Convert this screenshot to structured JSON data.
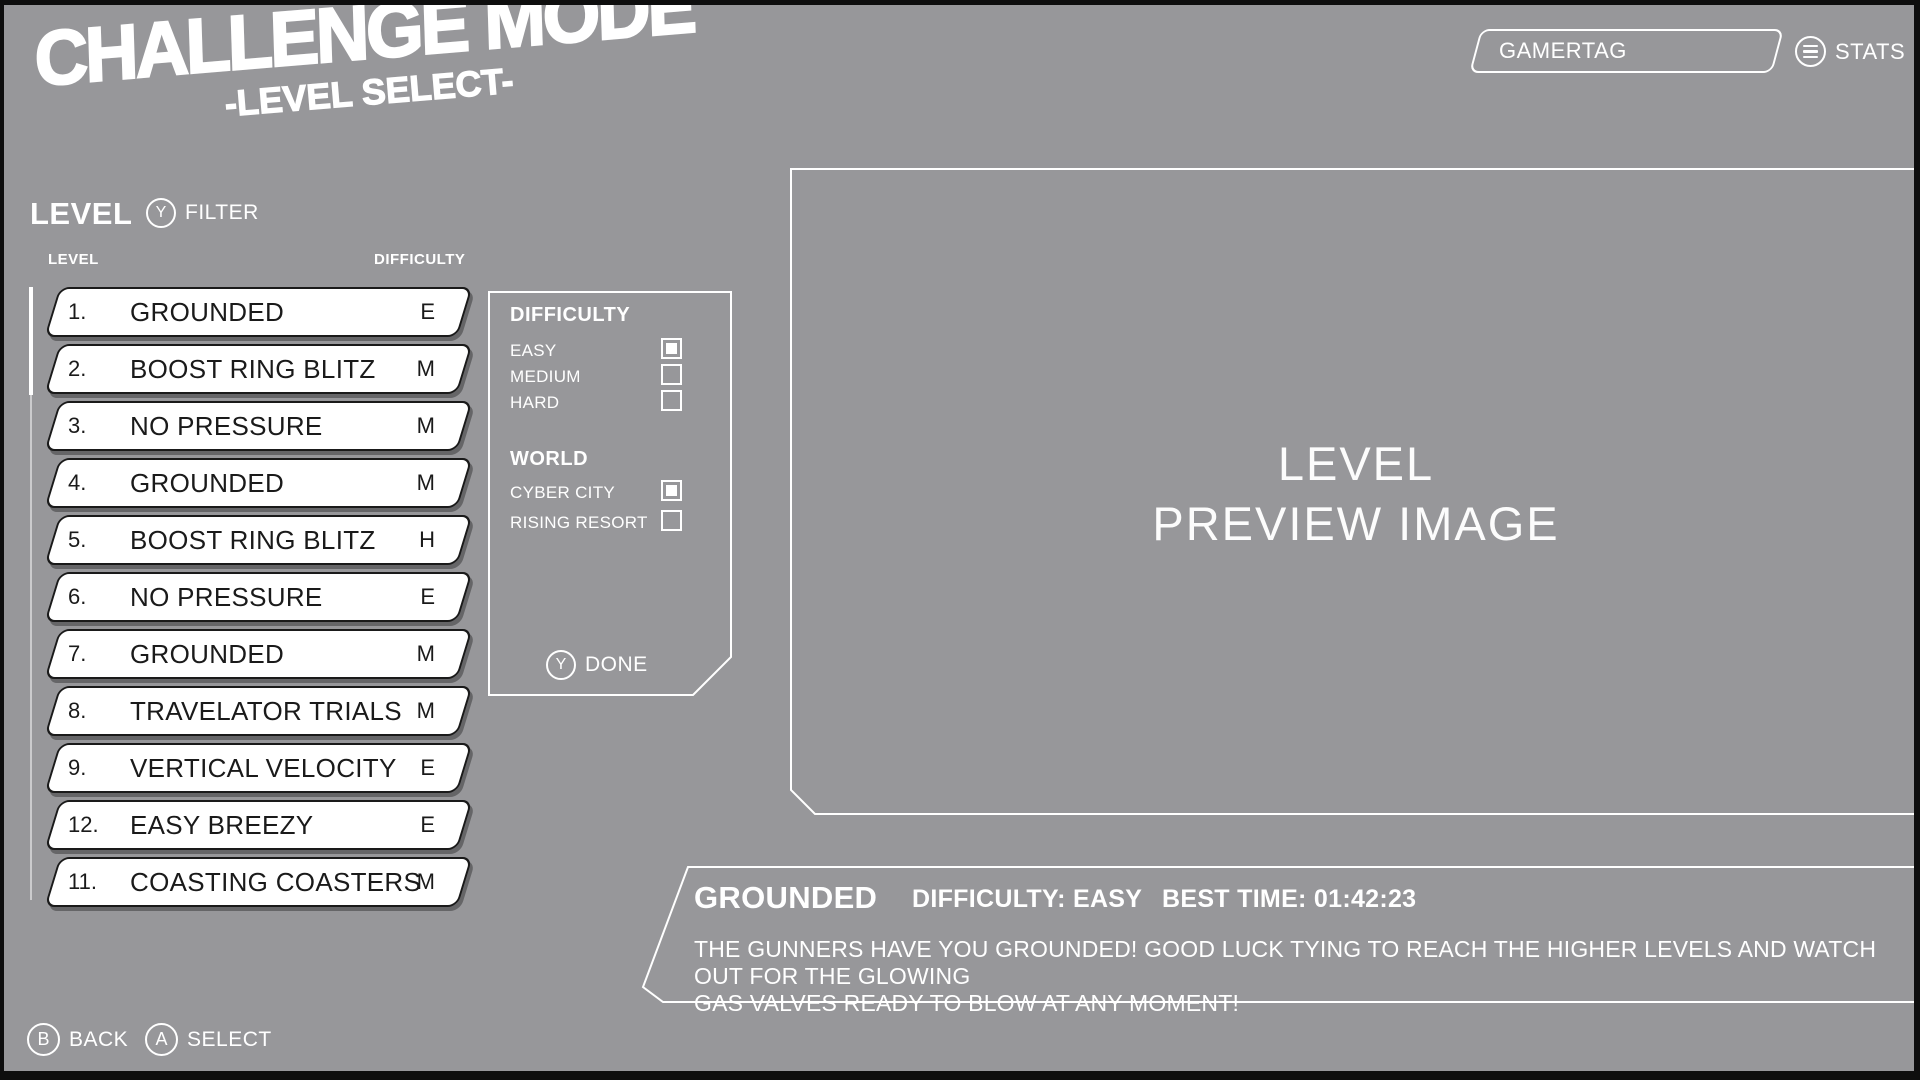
{
  "title": {
    "main": "CHALLENGE MODE",
    "subtitle": "-LEVEL SELECT-"
  },
  "topbar": {
    "gamertag_value": "GAMERTAG",
    "stats_label": "STATS"
  },
  "level_section": {
    "heading": "LEVEL",
    "filter_key": "Y",
    "filter_label": "FILTER",
    "col_level": "LEVEL",
    "col_difficulty": "DIFFICULTY"
  },
  "levels": [
    {
      "num": "1.",
      "name": "GROUNDED",
      "difficulty": "E"
    },
    {
      "num": "2.",
      "name": "BOOST RING BLITZ",
      "difficulty": "M"
    },
    {
      "num": "3.",
      "name": "NO PRESSURE",
      "difficulty": "M"
    },
    {
      "num": "4.",
      "name": "GROUNDED",
      "difficulty": "M"
    },
    {
      "num": "5.",
      "name": "BOOST RING BLITZ",
      "difficulty": "H"
    },
    {
      "num": "6.",
      "name": "NO PRESSURE",
      "difficulty": "E"
    },
    {
      "num": "7.",
      "name": "GROUNDED",
      "difficulty": "M"
    },
    {
      "num": "8.",
      "name": "TRAVELATOR TRIALS",
      "difficulty": "M"
    },
    {
      "num": "9.",
      "name": "VERTICAL VELOCITY",
      "difficulty": "E"
    },
    {
      "num": "12.",
      "name": "EASY BREEZY",
      "difficulty": "E"
    },
    {
      "num": "11.",
      "name": "COASTING COASTERS",
      "difficulty": "M"
    }
  ],
  "filter_panel": {
    "difficulty_heading": "DIFFICULTY",
    "difficulty_options": [
      {
        "label": "EASY",
        "checked": true
      },
      {
        "label": "MEDIUM",
        "checked": false
      },
      {
        "label": "HARD",
        "checked": false
      }
    ],
    "world_heading": "WORLD",
    "world_options": [
      {
        "label": "CYBER CITY",
        "checked": true
      },
      {
        "label": "RISING RESORT",
        "checked": false
      }
    ],
    "done_key": "Y",
    "done_label": "DONE"
  },
  "preview": {
    "line1": "LEVEL",
    "line2": "PREVIEW IMAGE"
  },
  "info_panel": {
    "level_name": "GROUNDED",
    "difficulty_text": "DIFFICULTY: EASY",
    "best_time_text": "BEST TIME: 01:42:23",
    "description_line1": "THE GUNNERS HAVE YOU GROUNDED! GOOD LUCK TYING TO REACH THE HIGHER LEVELS AND WATCH OUT FOR THE GLOWING",
    "description_line2": "GAS VALVES READY TO BLOW AT ANY MOMENT!"
  },
  "footer": {
    "back_key": "B",
    "back_label": "BACK",
    "select_key": "A",
    "select_label": "SELECT"
  },
  "colors": {
    "background": "#97979a",
    "panel_outline": "#ffffff",
    "button_fill": "#ffffff",
    "button_border": "#1a1a1a",
    "text_light": "#ffffff",
    "text_dark": "#1a1a1a",
    "page_border": "#0e0e0e"
  }
}
